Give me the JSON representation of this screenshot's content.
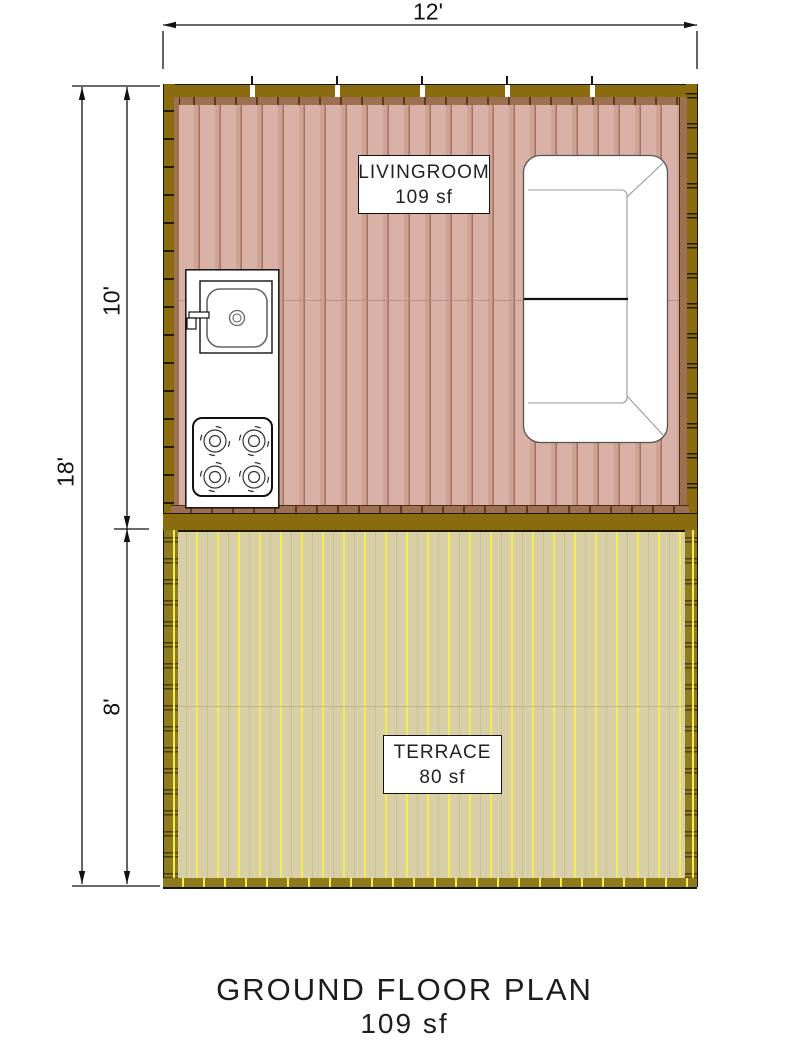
{
  "plan": {
    "title": "GROUND FLOOR PLAN",
    "title_area": "109 sf",
    "dimensions": {
      "overall_width": "12'",
      "overall_depth": "18'",
      "livingroom_depth": "10'",
      "terrace_depth": "8'"
    },
    "rooms": {
      "livingroom": {
        "name": "LIVINGROOM",
        "area": "109 sf"
      },
      "terrace": {
        "name": "TERRACE",
        "area": "80 sf"
      }
    },
    "fixtures": {
      "sink": "kitchen-sink",
      "stove": "four-burner-stove",
      "sofa": "two-seat-sofa"
    },
    "colors": {
      "wall_olive": "#8a6c0e",
      "wall_brown_trim": "#9c7050",
      "livingroom_floor": "#d9b1a6",
      "livingroom_plank_line": "#a5705e",
      "terrace_floor": "#d9cfa6",
      "terrace_plank_line": "#f2ee52",
      "terrace_frame": "#8f7a1e"
    }
  }
}
